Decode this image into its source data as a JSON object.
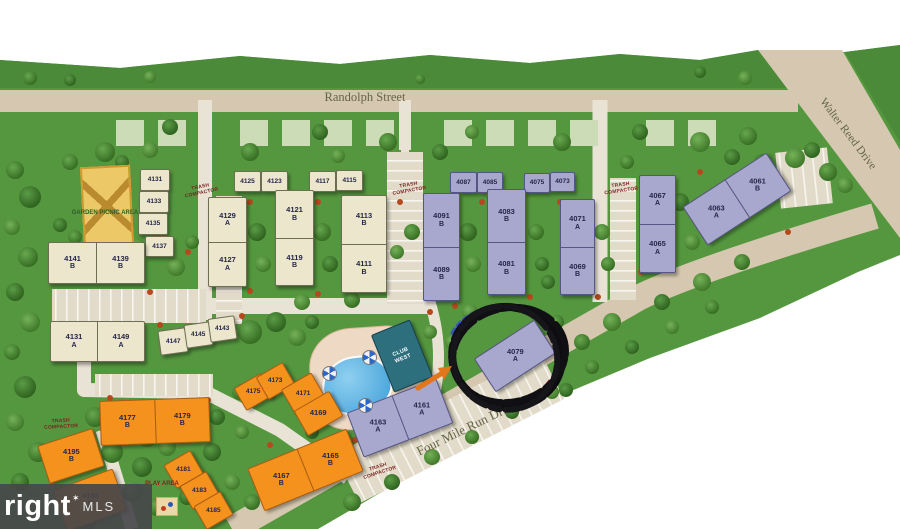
{
  "streets": {
    "randolph": "Randolph Street",
    "walter_reed": "Walter Reed Drive",
    "four_mile_run": "Four Mile Run Drive"
  },
  "amenities": {
    "garden_picnic_area": "GARDEN PICNIC AREA",
    "club_west": "CLUB WEST",
    "play_area": "PLAY AREA",
    "trash_compactor": "TRASH COMPACTOR"
  },
  "highlight": {
    "circled_building": "4079 A"
  },
  "watermark": {
    "big": "right",
    "star": "✶",
    "small": "MLS"
  },
  "colors": {
    "grass": "#55973f",
    "grass_dark": "#4a8a38",
    "road": "#d6c8b0",
    "road_light": "#e9e3d6",
    "building_cream": "#ebe6cc",
    "building_purple": "#a8a7ce",
    "building_orange": "#f5911d",
    "pool": "#3f9ed8",
    "club": "#2d6f7c",
    "annotation": "#111111"
  },
  "buildings": [
    {
      "id": "c4131",
      "color": "cream",
      "cells": [
        {
          "num": "4131"
        }
      ]
    },
    {
      "id": "c4133",
      "color": "cream",
      "cells": [
        {
          "num": "4133"
        }
      ]
    },
    {
      "id": "c4135",
      "color": "cream",
      "cells": [
        {
          "num": "4135"
        }
      ]
    },
    {
      "id": "c4137",
      "color": "cream",
      "cells": [
        {
          "num": "4137"
        }
      ]
    },
    {
      "id": "c4125",
      "color": "cream",
      "cells": [
        {
          "num": "4125"
        }
      ]
    },
    {
      "id": "c4123",
      "color": "cream",
      "cells": [
        {
          "num": "4123"
        }
      ]
    },
    {
      "id": "c4117",
      "color": "cream",
      "cells": [
        {
          "num": "4117"
        }
      ]
    },
    {
      "id": "c4115",
      "color": "cream",
      "cells": [
        {
          "num": "4115"
        }
      ]
    },
    {
      "id": "c4147",
      "color": "cream",
      "cells": [
        {
          "num": "4147"
        }
      ]
    },
    {
      "id": "c4145",
      "color": "cream",
      "cells": [
        {
          "num": "4145"
        }
      ]
    },
    {
      "id": "c4143",
      "color": "cream",
      "cells": [
        {
          "num": "4143"
        }
      ]
    },
    {
      "id": "c4141_4139",
      "color": "cream",
      "cells": [
        {
          "num": "4141",
          "letter": "B"
        },
        {
          "num": "4139",
          "letter": "B"
        }
      ]
    },
    {
      "id": "c4131a_4149",
      "color": "cream",
      "cells": [
        {
          "num": "4131",
          "letter": "A"
        },
        {
          "num": "4149",
          "letter": "A"
        }
      ]
    },
    {
      "id": "c4129_4127",
      "color": "cream",
      "cells": [
        {
          "num": "4129",
          "letter": "A"
        },
        {
          "num": "4127",
          "letter": "A"
        }
      ]
    },
    {
      "id": "c4121_4119",
      "color": "cream",
      "cells": [
        {
          "num": "4121",
          "letter": "B"
        },
        {
          "num": "4119",
          "letter": "B"
        }
      ]
    },
    {
      "id": "c4113_4111",
      "color": "cream",
      "cells": [
        {
          "num": "4113",
          "letter": "B"
        },
        {
          "num": "4111",
          "letter": "B"
        }
      ]
    },
    {
      "id": "p4087",
      "color": "purple",
      "cells": [
        {
          "num": "4087"
        }
      ]
    },
    {
      "id": "p4085",
      "color": "purple",
      "cells": [
        {
          "num": "4085"
        }
      ]
    },
    {
      "id": "p4075",
      "color": "purple",
      "cells": [
        {
          "num": "4075"
        }
      ]
    },
    {
      "id": "p4073",
      "color": "purple",
      "cells": [
        {
          "num": "4073"
        }
      ]
    },
    {
      "id": "p4091_4089",
      "color": "purple",
      "cells": [
        {
          "num": "4091",
          "letter": "B"
        },
        {
          "num": "4089",
          "letter": "B"
        }
      ]
    },
    {
      "id": "p4083_4081",
      "color": "purple",
      "cells": [
        {
          "num": "4083",
          "letter": "B"
        },
        {
          "num": "4081",
          "letter": "B"
        }
      ]
    },
    {
      "id": "p4071_4069",
      "color": "purple",
      "cells": [
        {
          "num": "4071",
          "letter": "A"
        },
        {
          "num": "4069",
          "letter": "B"
        }
      ]
    },
    {
      "id": "p4067_4065",
      "color": "purple",
      "cells": [
        {
          "num": "4067",
          "letter": "A"
        },
        {
          "num": "4065",
          "letter": "A"
        }
      ]
    },
    {
      "id": "p4063_4061",
      "color": "purple",
      "cells": [
        {
          "num": "4063",
          "letter": "A"
        },
        {
          "num": "4061",
          "letter": "B"
        }
      ]
    },
    {
      "id": "p4079",
      "color": "purple",
      "cells": [
        {
          "num": "4079",
          "letter": "A"
        }
      ]
    },
    {
      "id": "p4163_4161",
      "color": "purple",
      "cells": [
        {
          "num": "4163",
          "letter": "A"
        },
        {
          "num": "4161",
          "letter": "A"
        }
      ]
    },
    {
      "id": "o4177_4179",
      "color": "orange",
      "cells": [
        {
          "num": "4177",
          "letter": "B"
        },
        {
          "num": "4179",
          "letter": "B"
        }
      ]
    },
    {
      "id": "o4195",
      "color": "orange",
      "cells": [
        {
          "num": "4195",
          "letter": "B"
        }
      ]
    },
    {
      "id": "o4193",
      "color": "orange",
      "cells": [
        {
          "num": "4193",
          "letter": "B"
        }
      ]
    },
    {
      "id": "o4181",
      "color": "orange",
      "cells": [
        {
          "num": "4181"
        }
      ]
    },
    {
      "id": "o4183",
      "color": "orange",
      "cells": [
        {
          "num": "4183"
        }
      ]
    },
    {
      "id": "o4185",
      "color": "orange",
      "cells": [
        {
          "num": "4185"
        }
      ]
    },
    {
      "id": "o4175",
      "color": "orange",
      "cells": [
        {
          "num": "4175"
        }
      ]
    },
    {
      "id": "o4173",
      "color": "orange",
      "cells": [
        {
          "num": "4173"
        }
      ]
    },
    {
      "id": "o4171",
      "color": "orange",
      "cells": [
        {
          "num": "4171"
        }
      ]
    },
    {
      "id": "o4169",
      "color": "orange",
      "cells": [
        {
          "num": "4169"
        }
      ]
    },
    {
      "id": "o4167_4165",
      "color": "orange",
      "cells": [
        {
          "num": "4167",
          "letter": "B"
        },
        {
          "num": "4165",
          "letter": "B"
        }
      ]
    }
  ]
}
